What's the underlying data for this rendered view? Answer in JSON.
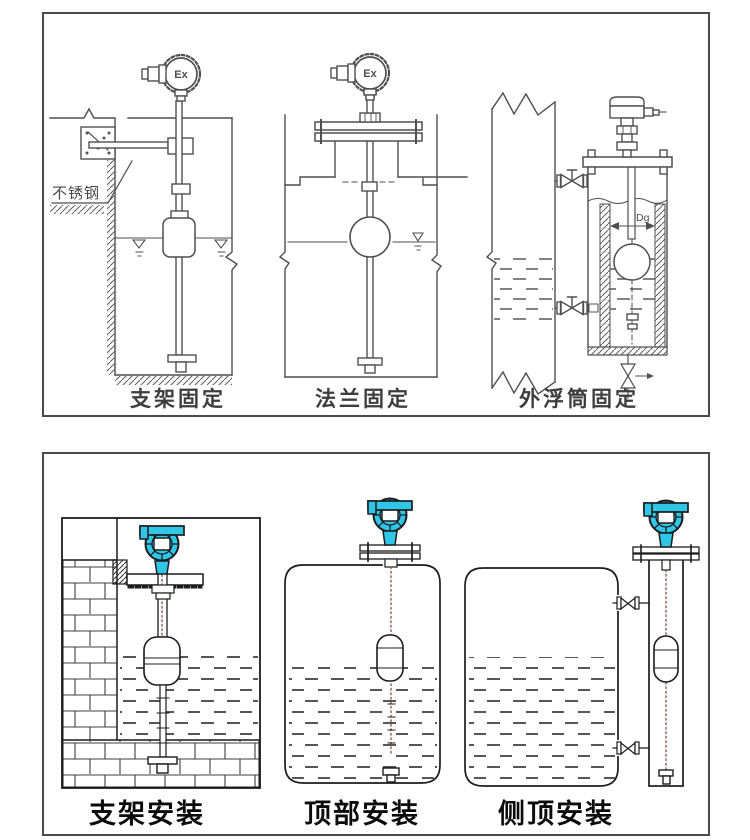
{
  "top_panel": {
    "captions": [
      {
        "label": "支架固定"
      },
      {
        "label": "法兰固定"
      },
      {
        "label": "外浮筒固定"
      }
    ],
    "stainless_note": "不锈钢",
    "ex_marking": "Ex",
    "diameter_label": "Dg"
  },
  "bottom_panel": {
    "captions": [
      {
        "label": "支架安装"
      },
      {
        "label": "顶部安装"
      },
      {
        "label": "侧顶安装"
      }
    ]
  },
  "colors": {
    "line": "#4f4f4f",
    "line_dark": "#1c1c1c",
    "transmitter_cyan": "#30c6e8",
    "stem_dot_brown": "#7a4438",
    "panel_border": "#4a4a4a",
    "background": "#ffffff"
  }
}
